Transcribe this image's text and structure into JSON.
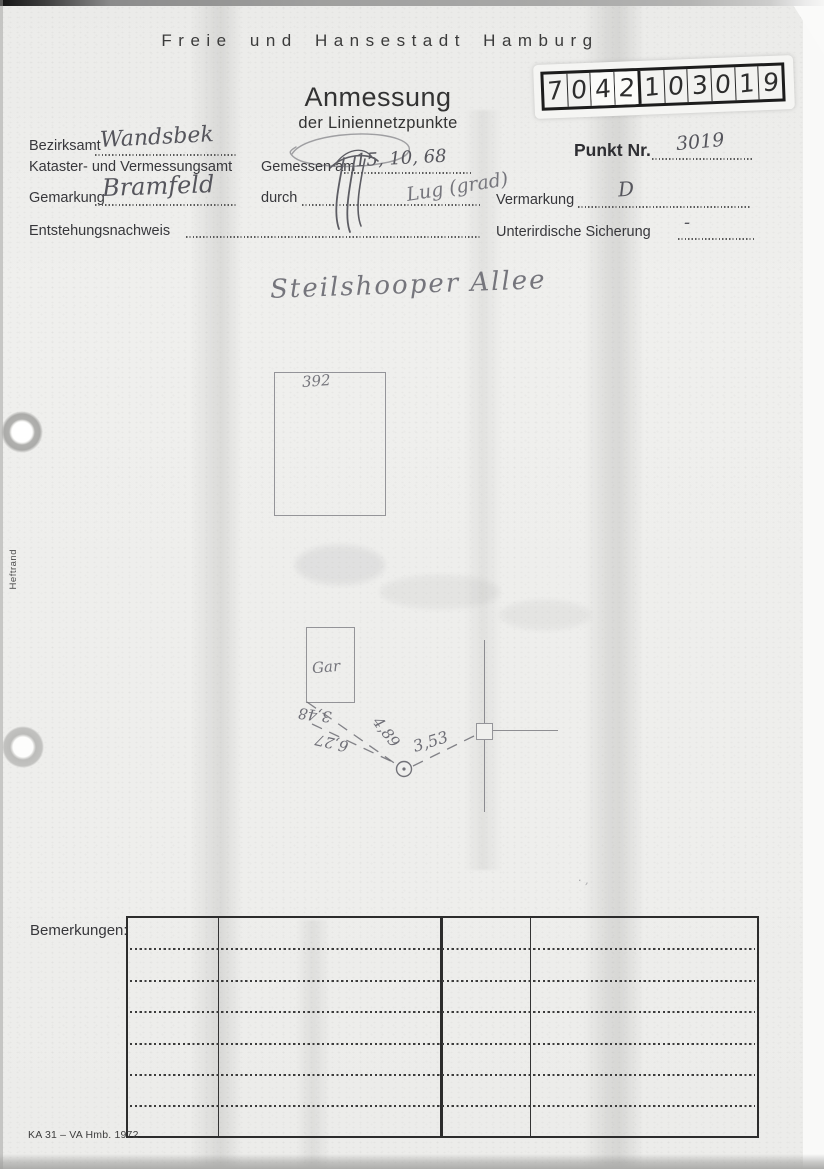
{
  "header": {
    "city": "Freie und Hansestadt Hamburg",
    "title": "Anmessung",
    "subtitle": "der Liniennetzpunkte"
  },
  "stamp": {
    "digits": [
      "7",
      "0",
      "4",
      "2",
      "1",
      "0",
      "3",
      "0",
      "1",
      "9"
    ]
  },
  "form": {
    "bezirksamt_label": "Bezirksamt",
    "bezirksamt_value": "Wandsbek",
    "kataster_label": "Kataster- und Vermessungsamt",
    "gemessen_label": "Gemessen am",
    "gemessen_value": "15, 10, 68",
    "punkt_label": "Punkt Nr.",
    "punkt_value": "3019",
    "gemarkung_label": "Gemarkung",
    "gemarkung_value": "Bramfeld",
    "durch_label": "durch",
    "durch_value": "Lug (grad)",
    "vermarkung_label": "Vermarkung",
    "vermarkung_value": "D",
    "entstehung_label": "Entstehungsnachweis",
    "unterirdisch_label": "Unterirdische Sicherung",
    "unterirdisch_value": "-"
  },
  "sketch": {
    "street": "Steilshooper Allee",
    "parcel_number": "392",
    "garage_label": "Gar",
    "measurements": {
      "m1": "3,48",
      "m2": "4,89",
      "m3": "6,27",
      "m4": "3,53"
    }
  },
  "remarks": {
    "label": "Bemerkungen:"
  },
  "margin": {
    "heftrand": "Heftrand"
  },
  "footer": {
    "form_code": "KA 31 – VA Hmb. 1972"
  },
  "colors": {
    "paper": "#efefed",
    "ink": "#37373b",
    "pencil": "#75757c"
  }
}
